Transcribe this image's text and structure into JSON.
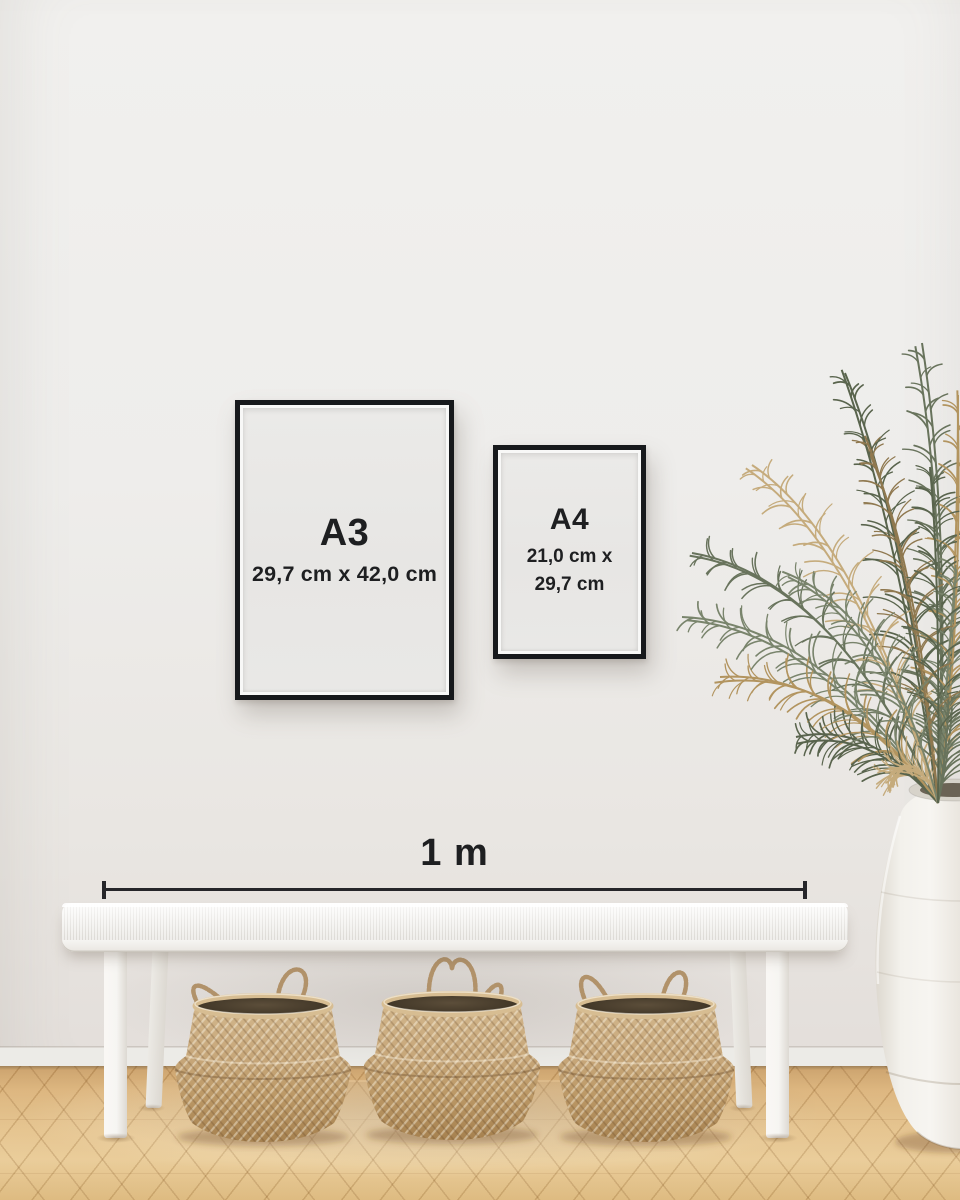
{
  "frames": {
    "a3": {
      "label": "A3",
      "size": "29,7 cm x 42,0 cm"
    },
    "a4": {
      "label": "A4",
      "size_line1": "21,0 cm x",
      "size_line2": "29,7 cm"
    }
  },
  "scale": {
    "label": "1 m"
  },
  "palette": {
    "ink": "#1e1f21",
    "frameBlack": "#17191c",
    "paper": "#e9e8e6",
    "wallTop": "#f1f0ee",
    "wallBottom": "#e3deda",
    "skirting": "#ecebe7",
    "floorLight": "#e8c994",
    "floorMid": "#d9b077",
    "floorDark": "#b98c52",
    "benchWhite": "#f6f5f2",
    "benchStripe": "#e4e2de",
    "basketLight": "#d5ba90",
    "basketMid": "#c3a276",
    "basketDark": "#a5804e",
    "basketInterior": "#3c3325",
    "handleRope": "#b1926a",
    "plantGreen1": "#68735c",
    "plantGreen2": "#59644d",
    "plantGreen3": "#79846c",
    "plantTan1": "#b2945f",
    "plantTan2": "#c5ab7c",
    "plantTan3": "#8f784f",
    "vaseWhite": "#f4f2ed",
    "scaleLine": "#26262a"
  }
}
